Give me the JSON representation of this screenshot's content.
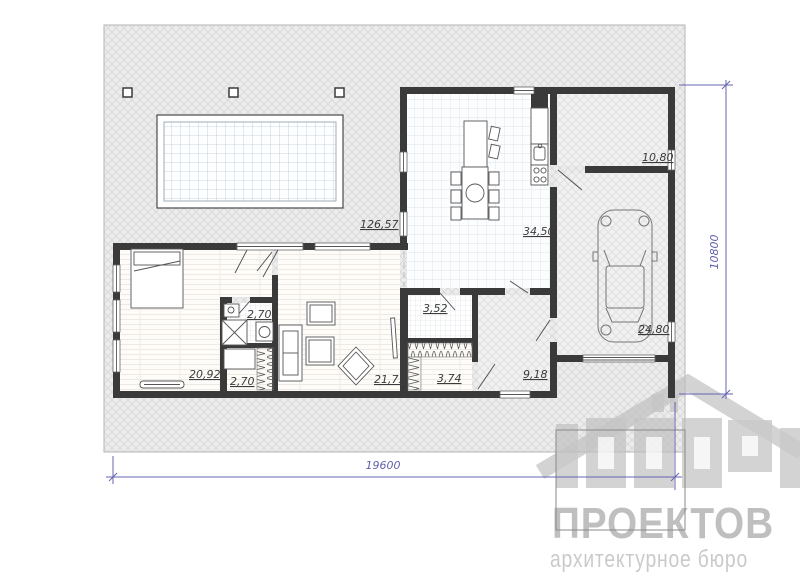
{
  "plan": {
    "area_labels": [
      {
        "room": "terrace",
        "text": "126,57"
      },
      {
        "room": "kitchen-dining",
        "text": "34,50"
      },
      {
        "room": "storage",
        "text": "10,80"
      },
      {
        "room": "garage",
        "text": "24,80"
      },
      {
        "room": "bedroom",
        "text": "20,92"
      },
      {
        "room": "bathroom-1",
        "text": "2,70"
      },
      {
        "room": "closet",
        "text": "2,70"
      },
      {
        "room": "living-room",
        "text": "21,75"
      },
      {
        "room": "bathroom-2",
        "text": "3,52"
      },
      {
        "room": "dressing",
        "text": "3,74"
      },
      {
        "room": "hall",
        "text": "9,18"
      }
    ],
    "dimensions": {
      "width_mm": "19600",
      "height_mm": "10800"
    }
  },
  "watermark": {
    "name": "ПРОЕКТОВ",
    "tagline": "архитектурное бюро"
  },
  "colors": {
    "wall": "#3a3a3a",
    "dimension_line": "#6464b0",
    "label_text": "#3b3b3b",
    "watermark_gray": "#bfbfbf",
    "terrace_hatch": "#d9d9d9",
    "tile_line": "#d3dde3"
  }
}
